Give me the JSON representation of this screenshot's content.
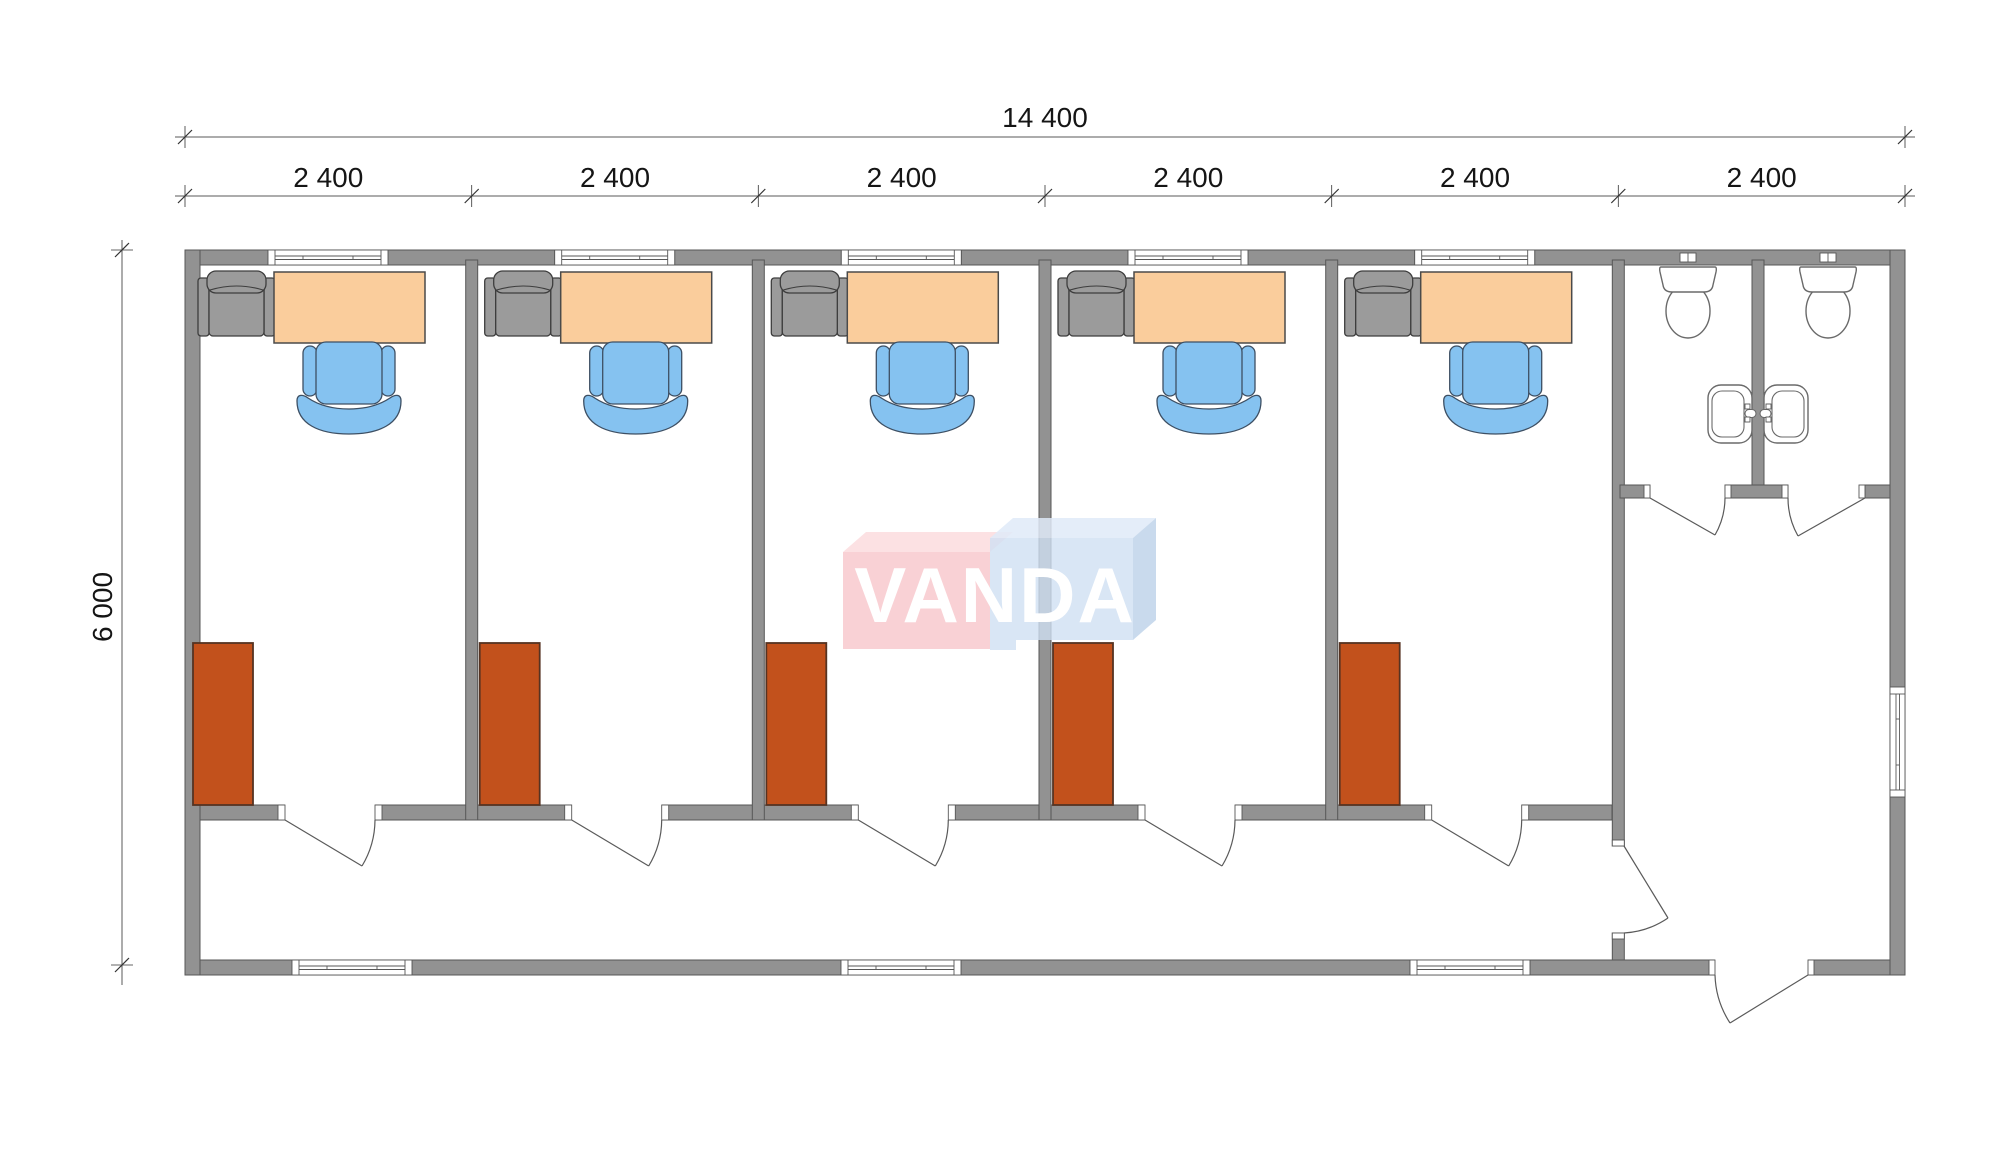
{
  "watermark": {
    "brand": "VANDA"
  },
  "dimensions": {
    "total_width": "14 400",
    "segments": [
      "2 400",
      "2 400",
      "2 400",
      "2 400",
      "2 400",
      "2 400"
    ],
    "height": "6 000"
  },
  "plan": {
    "office_rooms": 5,
    "wc_stalls": 2,
    "room_fixtures": [
      "desk",
      "office-chair",
      "visitor-armchair",
      "wardrobe",
      "window"
    ],
    "wc_fixtures": [
      "toilet",
      "toilet",
      "washbasin",
      "washbasin"
    ]
  },
  "colors": {
    "wall": "#929292",
    "wallStroke": "#575757",
    "line": "#5a5a5a",
    "fixtureStroke": "#6a6a6a",
    "desk": "#FACD9C",
    "deskStroke": "#4a4a4a",
    "chair": "#85C2F0",
    "chairStroke": "#3d4f63",
    "armchair": "#9B9B9B",
    "armchairStroke": "#3d3d3d",
    "wardrobe": "#C2511C",
    "wardrobeStroke": "#553322",
    "logoPink": "#F7C6CB",
    "logoPinkTop": "#FBDCDE",
    "logoBlue": "#CFE0F2",
    "logoBlueTop": "#DFEAF8",
    "logoBlueSide": "#C0D4EA",
    "logoText": "#FFFFFF"
  }
}
